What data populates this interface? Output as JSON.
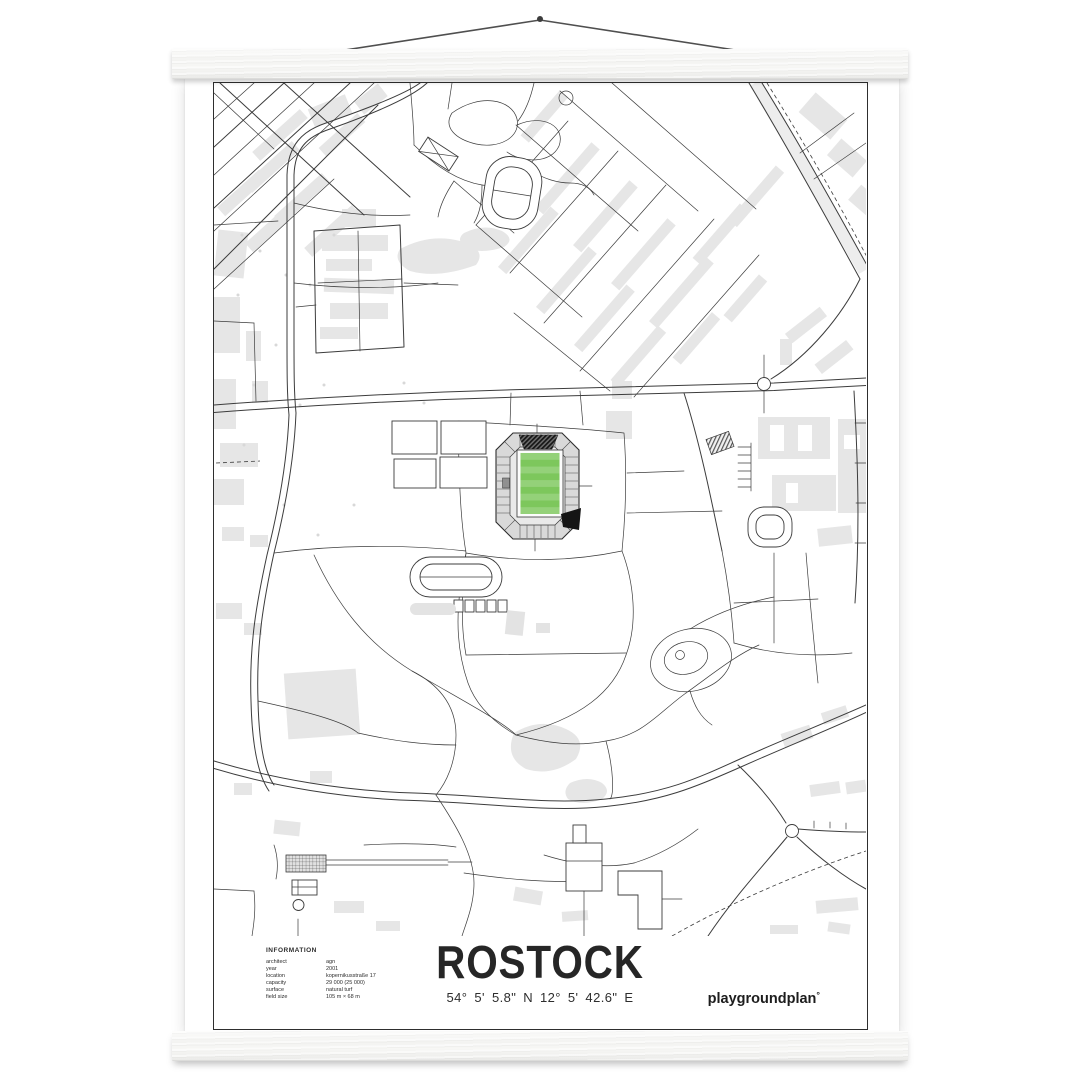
{
  "poster": {
    "title": "ROSTOCK",
    "coordinates": "54° 5' 5.8\" N  12° 5' 42.6\" E",
    "brand": "playgroundplan",
    "brand_mark": "°",
    "info": {
      "heading": "INFORMATION",
      "rows": [
        {
          "label": "architect",
          "value": "agn"
        },
        {
          "label": "year",
          "value": "2001"
        },
        {
          "label": "location",
          "value": "kopernikusstraße 17"
        },
        {
          "label": "capacity",
          "value": "29 000 (25 000)"
        },
        {
          "label": "surface",
          "value": "natural turf"
        },
        {
          "label": "field size",
          "value": "105 m × 68 m"
        }
      ]
    }
  },
  "colors": {
    "pitch_green": "#7dc75c",
    "map_line": "#3c3c3c",
    "building_gray": "#e6e6e6",
    "stand_gray": "#d9d9d9",
    "wedge_black": "#151515"
  }
}
